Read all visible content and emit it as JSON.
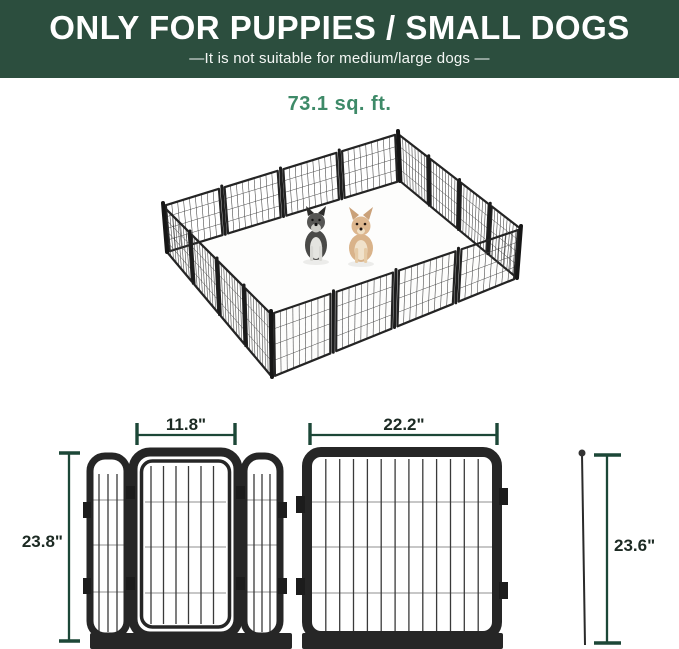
{
  "banner": {
    "title": "ONLY FOR PUPPIES / SMALL DOGS",
    "subtitle": "—It is not suitable for medium/large dogs —"
  },
  "illustration": {
    "area_label": "73.1 sq. ft.",
    "panel_count": 16,
    "dogs": [
      "schnauzer-puppy",
      "chihuahua-puppy"
    ]
  },
  "dimensions": {
    "door_width": "11.8\"",
    "panel_height": "23.8\"",
    "panel_width": "22.2\"",
    "stake_height": "23.6\""
  },
  "colors": {
    "banner-green": "#2C4E3E",
    "accent-green": "#3E8A68",
    "dim-green": "#1C4737",
    "dim-text": "#1C2A23",
    "fence-black": "#262626"
  }
}
